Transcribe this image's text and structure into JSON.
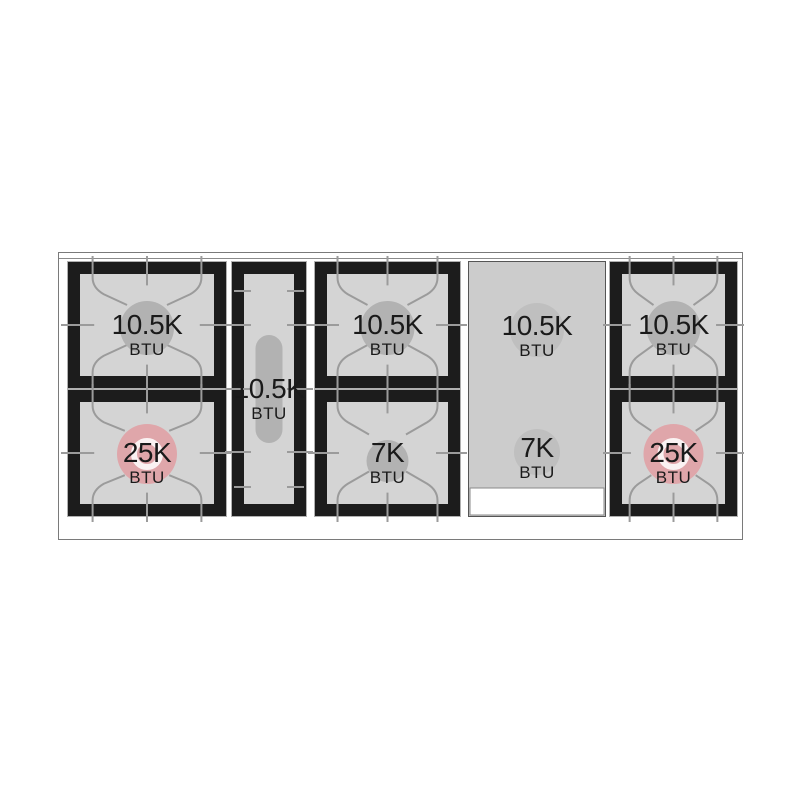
{
  "cooktop": {
    "unit_label": "BTU",
    "burners": [
      {
        "name": "left-rear-burner",
        "value": "10.5K",
        "unit": "BTU",
        "center_style": "gray"
      },
      {
        "name": "left-front-burner",
        "value": "25K",
        "unit": "BTU",
        "center_style": "pink-ring"
      },
      {
        "name": "center-oval-burner",
        "value": "10.5K",
        "unit": "BTU",
        "center_style": "oval"
      },
      {
        "name": "middle-rear-burner",
        "value": "10.5K",
        "unit": "BTU",
        "center_style": "gray"
      },
      {
        "name": "middle-front-burner",
        "value": "7K",
        "unit": "BTU",
        "center_style": "gray-small"
      },
      {
        "name": "griddle-rear-burner",
        "value": "10.5K",
        "unit": "BTU",
        "center_style": "griddle"
      },
      {
        "name": "griddle-front-burner",
        "value": "7K",
        "unit": "BTU",
        "center_style": "griddle"
      },
      {
        "name": "right-rear-burner",
        "value": "10.5K",
        "unit": "BTU",
        "center_style": "gray"
      },
      {
        "name": "right-front-burner",
        "value": "25K",
        "unit": "BTU",
        "center_style": "pink-ring"
      }
    ],
    "colors": {
      "frame": "#1c1c1c",
      "surface": "#d4d4d4",
      "grate_line": "#9b9b9b",
      "burner_center_gray": "#b2b2b2",
      "burner_center_pink": "#dfa6aa",
      "griddle_surface": "#cccccc",
      "griddle_circle": "#bfbfbf",
      "griddle_border": "#555555",
      "module_outline": "#b0b0b0",
      "outer_border": "#7a7a7a",
      "trim_line": "#8a8a8a",
      "tray_fill": "#ffffff",
      "label_text": "#1a1a1a"
    }
  }
}
